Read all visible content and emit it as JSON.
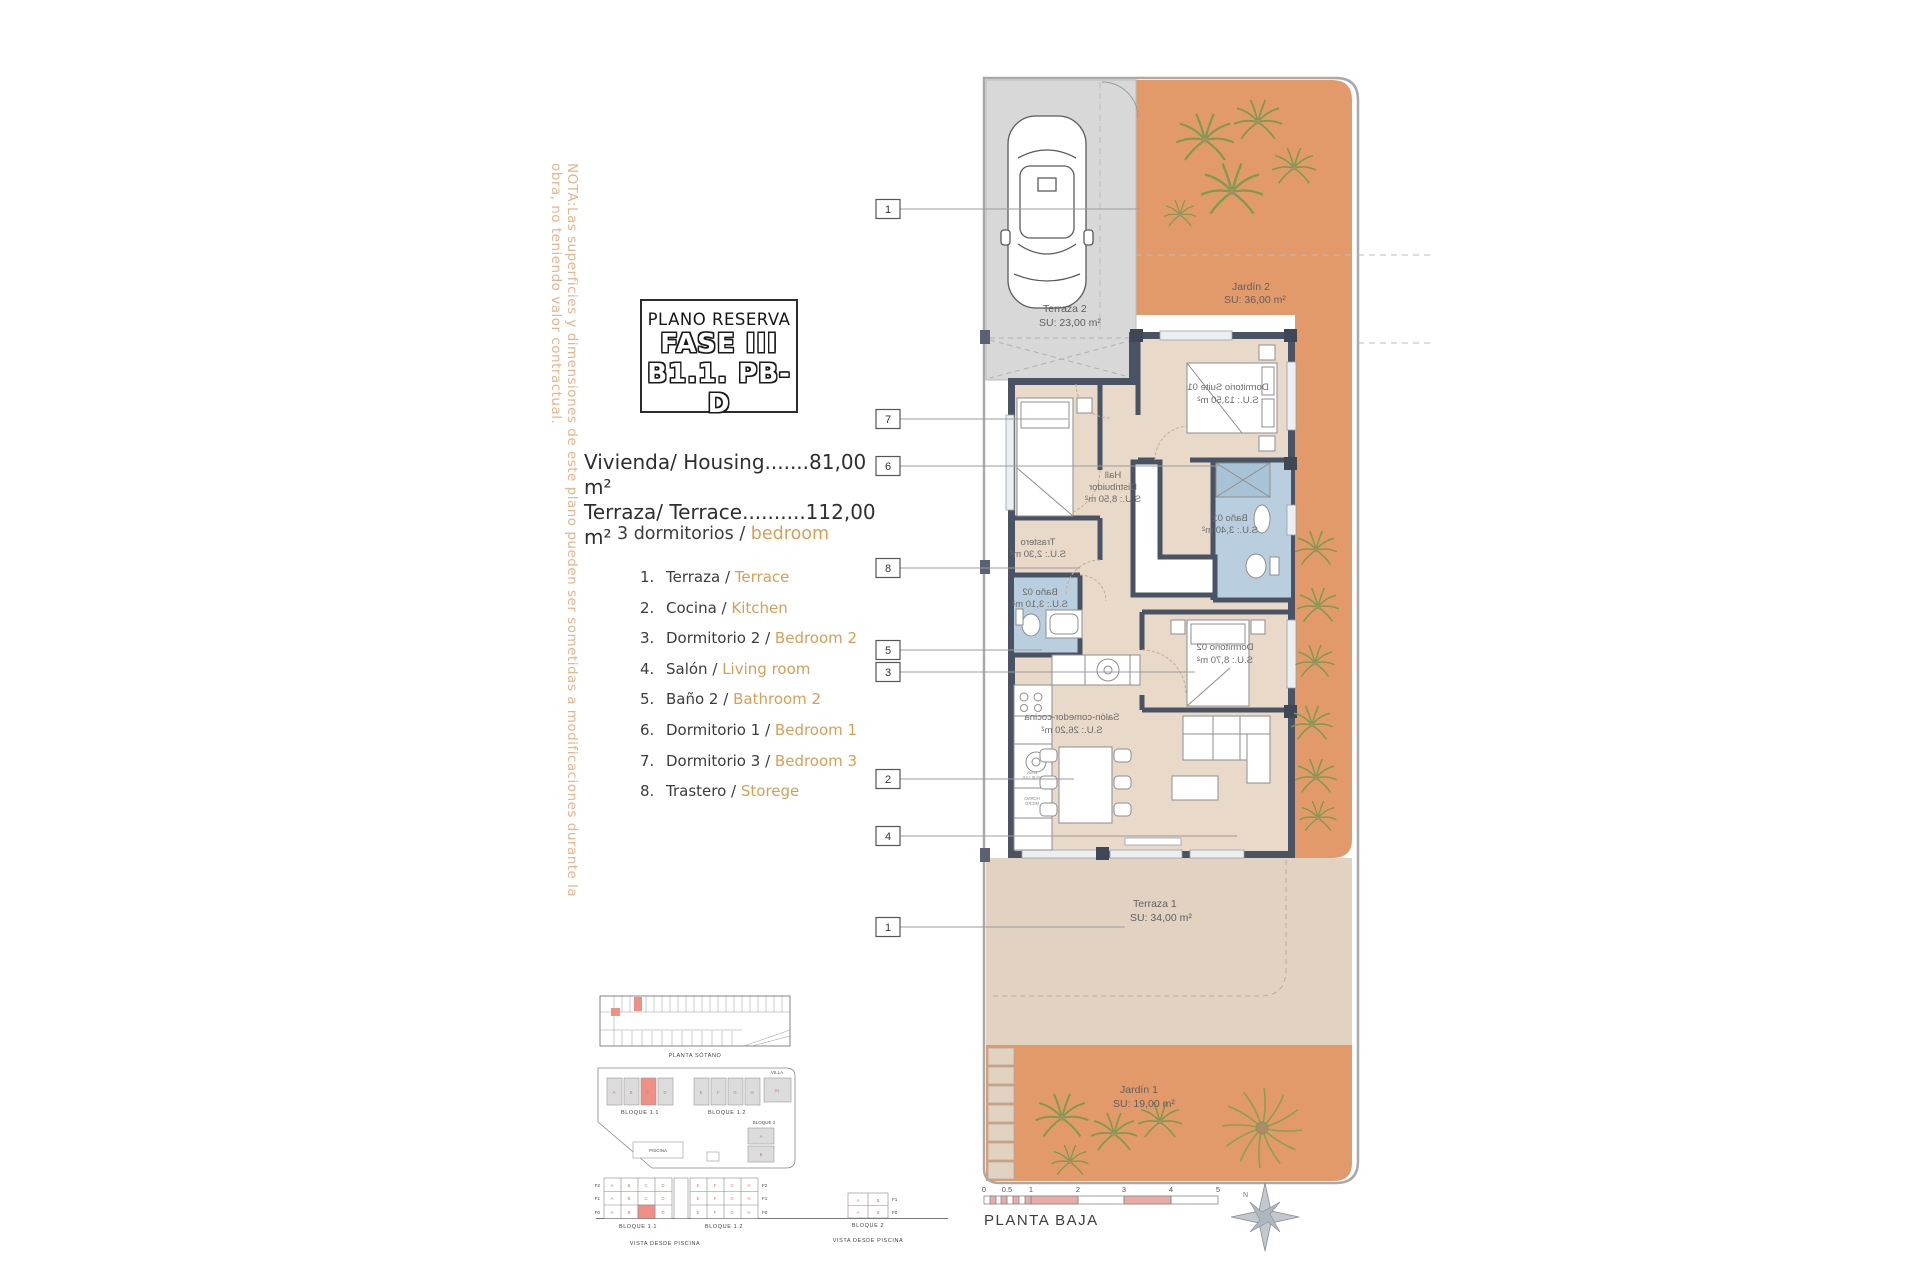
{
  "note_vertical": "NOTA:Las superficies y dimensiones de este plano pueden ser sometidas a modificaciones durante la obra, no teniendo valor contractual.",
  "title_block": {
    "line1": "PLANO RESERVA",
    "line2": "FASE III",
    "line3": "B1.1. PB-D"
  },
  "summary": {
    "housing": "Vivienda/ Housing.......81,00 m²",
    "terrace": "Terraza/ Terrace..........112,00 m²",
    "bedrooms_es": "3 dormitorios /",
    "bedrooms_en": "bedroom"
  },
  "legend": {
    "items": [
      {
        "num": "1.",
        "es": "Terraza",
        "sep": "/",
        "en": "Terrace"
      },
      {
        "num": "2.",
        "es": "Cocina",
        "sep": "/",
        "en": "Kitchen"
      },
      {
        "num": "3.",
        "es": "Dormitorio 2",
        "sep": "/",
        "en": "Bedroom 2"
      },
      {
        "num": "4.",
        "es": "Salón",
        "sep": "/",
        "en": "Living room"
      },
      {
        "num": "5.",
        "es": "Baño 2",
        "sep": "/",
        "en": "Bathroom 2"
      },
      {
        "num": "6.",
        "es": "Dormitorio 1",
        "sep": "/",
        "en": "Bedroom 1"
      },
      {
        "num": "7.",
        "es": "Dormitorio 3",
        "sep": "/",
        "en": "Bedroom 3"
      },
      {
        "num": "8.",
        "es": "Trastero",
        "sep": "/",
        "en": "Storege"
      }
    ]
  },
  "plan": {
    "callouts": [
      "1",
      "7",
      "6",
      "8",
      "5",
      "3",
      "2",
      "4",
      "1"
    ],
    "areas": {
      "terraza2": {
        "name": "Terraza 2",
        "su": "SU: 23,00 m²"
      },
      "jardin2": {
        "name": "Jardín 2",
        "su": "SU: 36,00 m²"
      },
      "terraza1": {
        "name": "Terraza 1",
        "su": "SU: 34,00 m²"
      },
      "jardin1": {
        "name": "Jardín 1",
        "su": "SU: 19,00 m²"
      }
    },
    "rooms": {
      "suite": {
        "name": "Dormitorio Suite 01",
        "su": "S.U.: 13,50 m²"
      },
      "hall": {
        "l1": "Hall",
        "l2": "Distribuidor",
        "l3": "S.U.: 8,50 m²"
      },
      "bano01": {
        "name": "Baño 01",
        "su": "S.U.: 3,40 m²"
      },
      "trastero": {
        "name": "Trastero",
        "su": "S.U.: 2,30 m²"
      },
      "bano02": {
        "name": "Baño 02",
        "su": "S.U.: 3,10 m²"
      },
      "dorm02": {
        "name": "Dormitorio 02",
        "su": "S.U.: 8,70 m²"
      },
      "salon": {
        "name": "Salón-comedor-cocina",
        "su": "S.U.: 26,20 m²"
      }
    },
    "kitchen": {
      "l1a": "LAVA",
      "l1b": "VAJILLAS",
      "l2a": "HORNO",
      "l2b": "MICRO"
    },
    "scalebar": {
      "ticks": [
        "0",
        "0.5",
        "1",
        "2",
        "3",
        "4",
        "5"
      ],
      "caption": "PLANTA BAJA"
    },
    "north": "N"
  },
  "site": {
    "sotano": "PLANTA SÓTANO",
    "b11": "BLOQUE 1.1",
    "b12": "BLOQUE 1.2",
    "b2": "BLOQUE 2",
    "villa": "VILLA",
    "villa_unit": "01",
    "piscina": "PISCINA",
    "vista": "VISTA DESDE PISCINA",
    "floors": [
      "F2",
      "F1",
      "F0"
    ],
    "floors2": [
      "F1",
      "F0"
    ],
    "letters11": [
      "A",
      "B",
      "C",
      "D"
    ],
    "letters12": [
      "E",
      "F",
      "G",
      "H"
    ],
    "letters2": [
      "A",
      "B"
    ]
  },
  "colors": {
    "accent_orange": "#d99e55",
    "garden_orange": "#e29a6a",
    "wall_dark": "#4a5364",
    "bath_blue": "#b9cfdf",
    "room_beige": "#e9d9c9",
    "terrace_beige": "#e2d2c2",
    "parking_gray": "#d8d8d8",
    "highlight_red": "#ee9086",
    "scalebar_pink": "#e7aca4",
    "note_orange": "#e6b48c",
    "palm_green": "#7d9b4a"
  }
}
